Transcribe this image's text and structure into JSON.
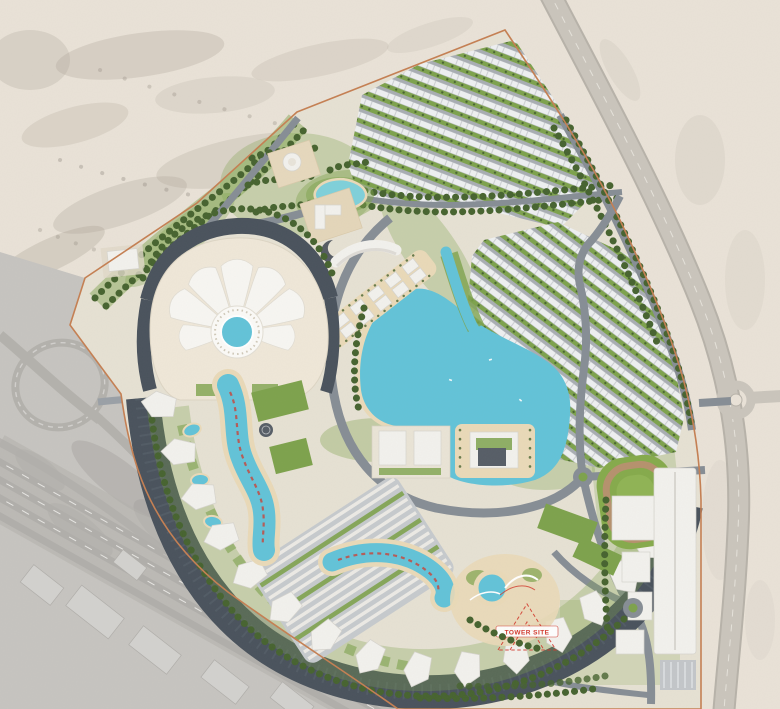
{
  "labels": {
    "tower_site": "TOWER SITE"
  },
  "palette": {
    "desert": "#e9e2d7",
    "shadow": "#a89f93",
    "grayzone": "#c6c4c0",
    "grayroad": "#b3b1ac",
    "extroad": "#cac5bc",
    "sitesand": "#e6e1d3",
    "boundary": "#c57f52",
    "roaddark": "#49525c",
    "roadmid": "#868d95",
    "street": "#9aa0a6",
    "green": "#7da24c",
    "greendark": "#46632f",
    "fieldgreen": "#85aa4b",
    "track": "#b5916d",
    "lagoon": "#62c3d8",
    "lagoonlight": "#7fd0da",
    "beach": "#e9d9b8",
    "building": "#f2f1ed",
    "buildingshade": "#d6d4ce",
    "cream": "#efe7d8",
    "red": "#d2382c",
    "white": "#ffffff"
  }
}
